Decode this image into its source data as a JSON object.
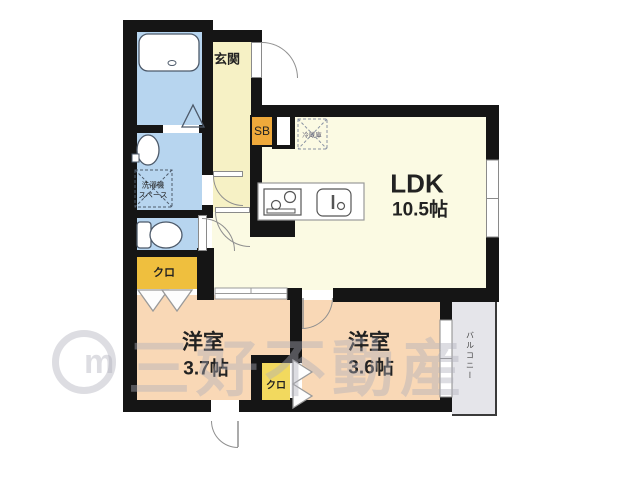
{
  "plan_title": "floorplan",
  "rooms": {
    "entrance": {
      "label": "玄関"
    },
    "ldk": {
      "label": "LDK",
      "size": "10.5帖"
    },
    "bedroom_a": {
      "label": "洋室",
      "size": "3.7帖"
    },
    "bedroom_b": {
      "label": "洋室",
      "size": "3.6帖"
    },
    "balcony": {
      "label": "バルコニー"
    }
  },
  "storage": {
    "shoe_box": {
      "label": "SB"
    },
    "closet_a": {
      "label": "クロ"
    },
    "closet_b": {
      "label": "クロ"
    }
  },
  "fixtures": {
    "laundry_space": {
      "line1": "洗濯機",
      "line2": "スペース"
    },
    "refrigerator": {
      "label": "冷蔵庫"
    }
  },
  "watermark": {
    "text": "三好不動産",
    "logo_letter": "m"
  },
  "colors": {
    "wall": "#151515",
    "wet_area_floor": "#b7d5ef",
    "hall_floor": "#f6f1c5",
    "ldk_floor": "#fbfae3",
    "bedroom_floor": "#f9d8b6",
    "shoe_box": "#efa93b",
    "closet_a": "#efbf3e",
    "closet_b": "#f2d95e",
    "balcony": "#e5e5ea",
    "watermark": "#afafb9"
  }
}
